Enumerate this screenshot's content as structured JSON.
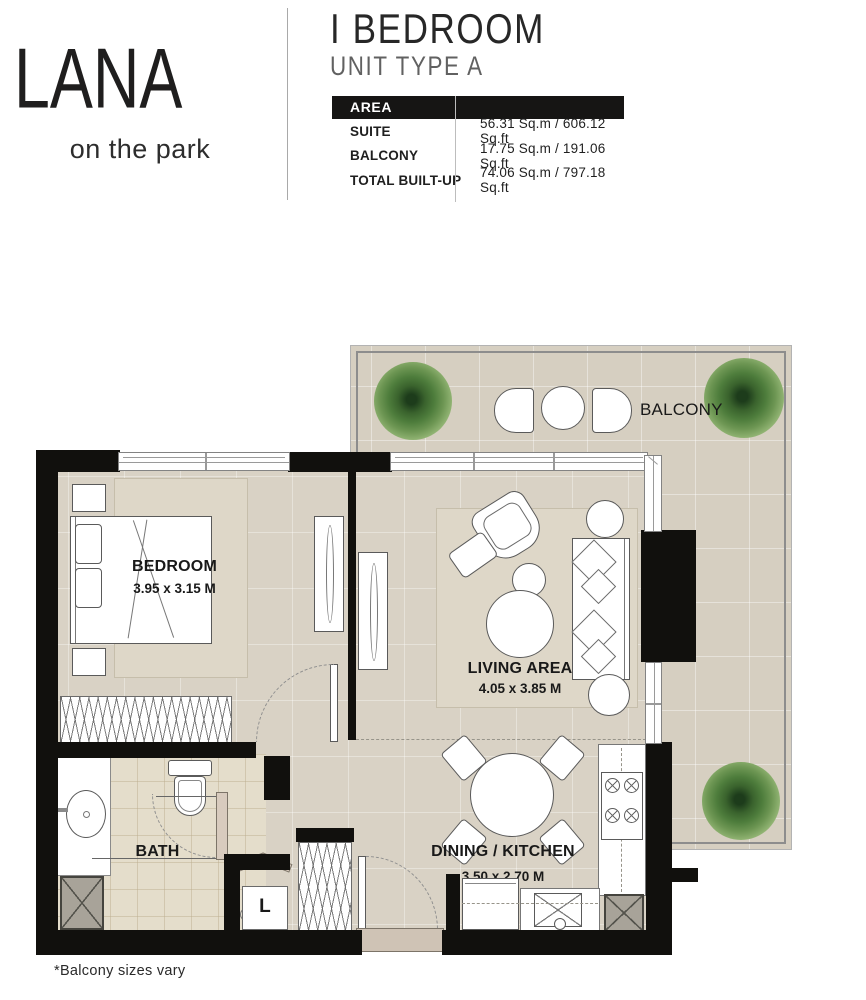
{
  "brand": {
    "name": "LANA",
    "tagline": "on the park"
  },
  "unit": {
    "title": "I BEDROOM",
    "subtitle": "UNIT TYPE A"
  },
  "area_table": {
    "header": "AREA",
    "rows": [
      {
        "label": "SUITE",
        "value": "56.31 Sq.m / 606.12 Sq.ft"
      },
      {
        "label": "BALCONY",
        "value": "17.75 Sq.m / 191.06 Sq.ft"
      },
      {
        "label": "TOTAL BUILT-UP",
        "value": "74.06 Sq.m / 797.18 Sq.ft"
      }
    ]
  },
  "plan": {
    "balcony": {
      "name": "BALCONY"
    },
    "bedroom": {
      "name": "BEDROOM",
      "dims": "3.95 x 3.15 M"
    },
    "living": {
      "name": "LIVING AREA",
      "dims": "4.05 x 3.85 M"
    },
    "dining": {
      "name": "DINING / KITCHEN",
      "dims": "3.50 x 2.70 M"
    },
    "bath": {
      "name": "BATH"
    },
    "laundry": {
      "name": "L"
    }
  },
  "footnote": "*Balcony sizes vary",
  "colors": {
    "wall": "#11100d",
    "floor": "#d9d2c5",
    "balcony_floor": "#d6cfc1",
    "bath_tile": "#e4ddcb",
    "rug": "#ded7c8",
    "plant_green": "#4e7d3c",
    "table_header_bg": "#161514",
    "table_header_text": "#ffffff"
  }
}
